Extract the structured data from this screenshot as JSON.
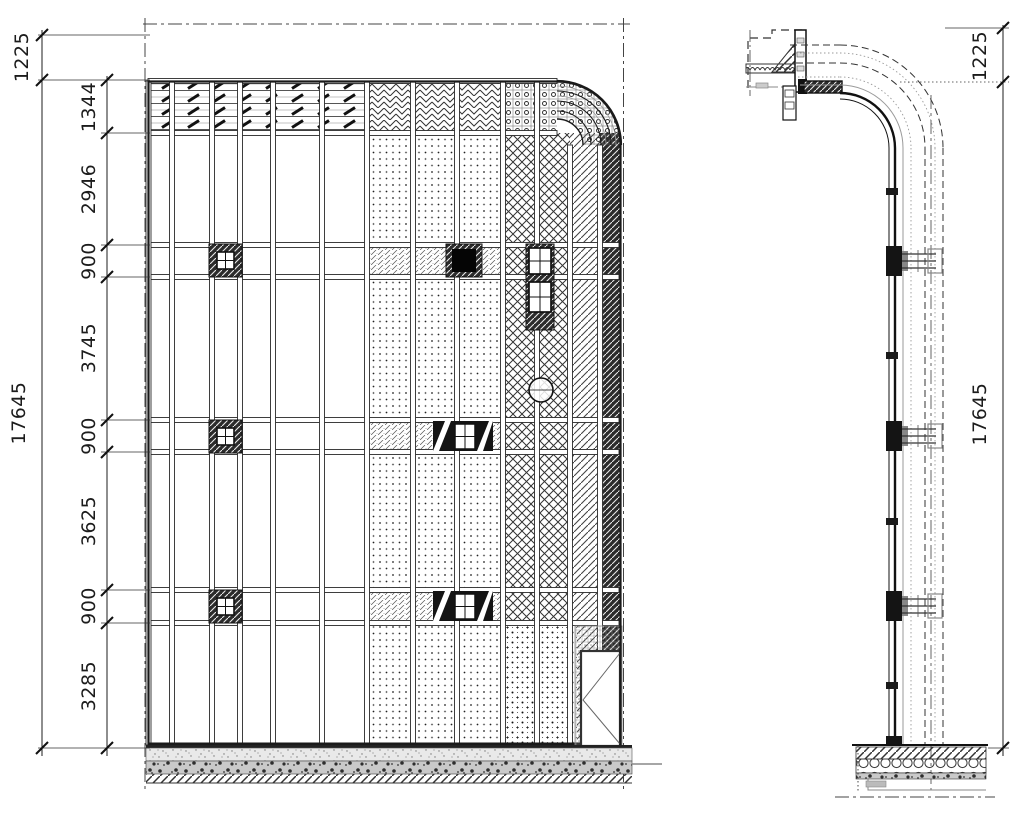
{
  "drawing": {
    "type": "curtain-wall construction drawing",
    "views": [
      "facade elevation",
      "vertical section"
    ]
  },
  "elevation": {
    "dim_parapet": "1225",
    "dim_overall": "17645",
    "dim_chain": [
      "1344",
      "2946",
      "900",
      "3745",
      "900",
      "3625",
      "900",
      "3285"
    ]
  },
  "section": {
    "dim_parapet": "1225",
    "dim_overall": "17645"
  },
  "colors": {
    "ink": "#1c1c1c",
    "medium": "#555555",
    "gray": "#9a9a9a",
    "light_gray": "#c9c9c9",
    "background": "#ffffff"
  }
}
